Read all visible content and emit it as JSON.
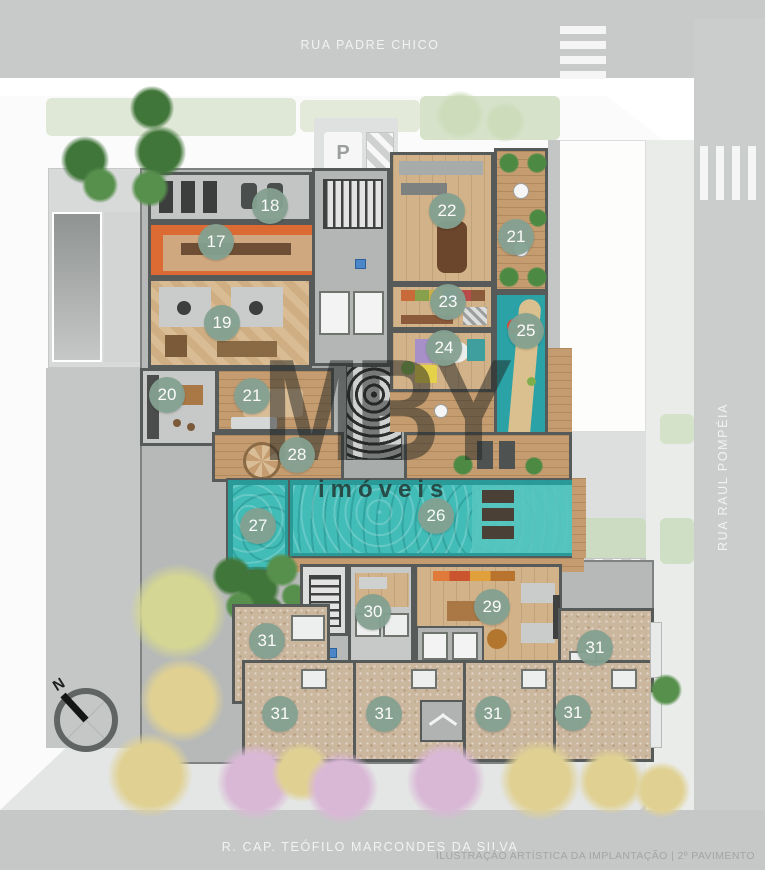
{
  "streets": {
    "top": "RUA PADRE CHICO",
    "right": "RUA RAUL POMPÉIA",
    "bottom": "R. CAP. TEÓFILO MARCONDES DA SILVA"
  },
  "caption": "ILUSTRAÇÃO ARTÍSTICA DA IMPLANTAÇÃO | 2º PAVIMENTO",
  "watermark": {
    "brand": "MBY",
    "sub": "imóveis"
  },
  "compass": {
    "label": "N"
  },
  "signs": {
    "parking": "P",
    "accessible": "♿"
  },
  "badges": [
    {
      "label": "18",
      "x": 270,
      "y": 206
    },
    {
      "label": "17",
      "x": 216,
      "y": 242
    },
    {
      "label": "19",
      "x": 222,
      "y": 323
    },
    {
      "label": "20",
      "x": 167,
      "y": 395
    },
    {
      "label": "21",
      "x": 252,
      "y": 396
    },
    {
      "label": "22",
      "x": 447,
      "y": 211
    },
    {
      "label": "21",
      "x": 516,
      "y": 237
    },
    {
      "label": "23",
      "x": 448,
      "y": 302
    },
    {
      "label": "24",
      "x": 444,
      "y": 348
    },
    {
      "label": "25",
      "x": 526,
      "y": 331
    },
    {
      "label": "28",
      "x": 297,
      "y": 455
    },
    {
      "label": "27",
      "x": 258,
      "y": 526
    },
    {
      "label": "26",
      "x": 436,
      "y": 516
    },
    {
      "label": "30",
      "x": 373,
      "y": 612
    },
    {
      "label": "29",
      "x": 492,
      "y": 607
    },
    {
      "label": "31",
      "x": 267,
      "y": 641
    },
    {
      "label": "31",
      "x": 595,
      "y": 648
    },
    {
      "label": "31",
      "x": 280,
      "y": 714
    },
    {
      "label": "31",
      "x": 384,
      "y": 714
    },
    {
      "label": "31",
      "x": 493,
      "y": 714
    },
    {
      "label": "31",
      "x": 573,
      "y": 713
    }
  ],
  "colors": {
    "badge_green": "#84a191",
    "pool_teal": "#41bcb7",
    "playground_teal": "#2aa2a6",
    "wood_floor": "#d2b289",
    "deck_wood": "#c49c6f",
    "wall_gray": "#565a59",
    "road_gray": "#c8cac9",
    "accent_orange": "#dc6a33"
  }
}
